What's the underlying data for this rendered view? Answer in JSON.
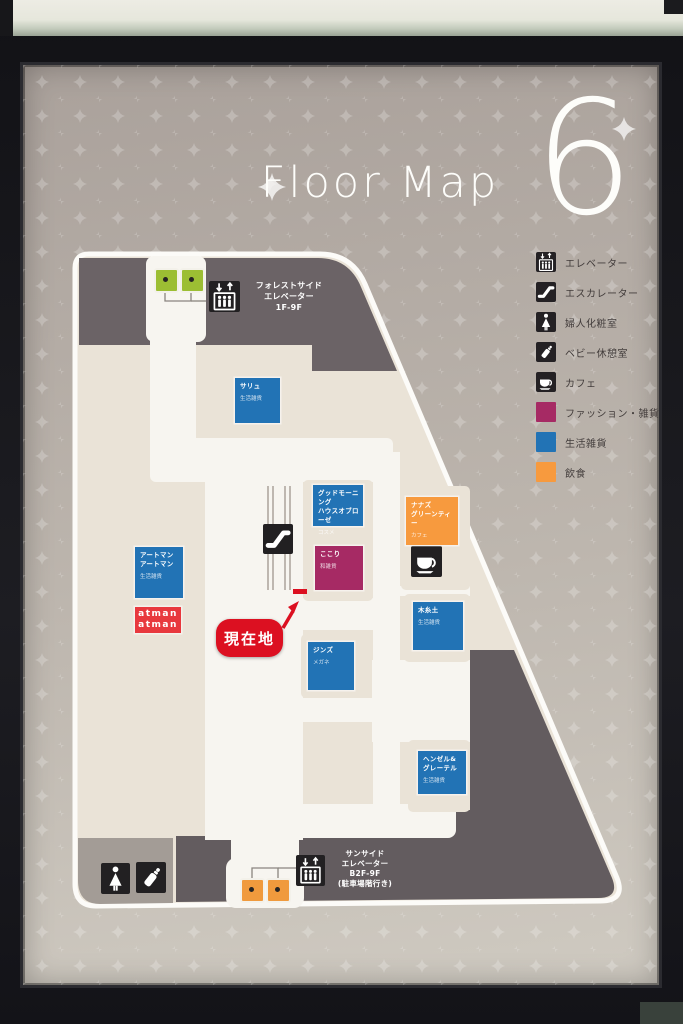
{
  "sign": {
    "title": "Floor Map",
    "floor_number": "6",
    "legend": {
      "items": [
        {
          "icon": "elevator-icon",
          "label": "エレベーター"
        },
        {
          "icon": "escalator-icon",
          "label": "エスカレーター"
        },
        {
          "icon": "powder-room-icon",
          "label": "婦人化粧室"
        },
        {
          "icon": "baby-room-icon",
          "label": "ベビー休憩室"
        },
        {
          "icon": "cafe-icon",
          "label": "カフェ"
        },
        {
          "swatch": "#a62a64",
          "label": "ファッション・雑貨"
        },
        {
          "swatch": "#2273b5",
          "label": "生活雑貨"
        },
        {
          "swatch": "#f79a3e",
          "label": "飲食"
        }
      ]
    },
    "map": {
      "current_location": "現在地",
      "elevator_forest": {
        "label": "フォレストサイド\nエレベーター\n1F-9F"
      },
      "elevator_sun": {
        "label": "サンサイド\nエレベーター\nB2F-9F\n(駐車場階行き)"
      },
      "stores": [
        {
          "name": "サリュ",
          "category": "生活雑貨",
          "color": "#2273b5"
        },
        {
          "name": "グッドモーニング\nハウスオブローゼ",
          "category": "コスメ",
          "color": "#2273b5"
        },
        {
          "name": "ここり",
          "category": "和雑貨",
          "color": "#a62a64"
        },
        {
          "name": "ナナズ\nグリーンティー",
          "category": "カフェ",
          "color": "#f79a3e"
        },
        {
          "name": "アートマン\nアートマン",
          "category": "生活雑貨",
          "color": "#2273b5"
        },
        {
          "name": "ジンズ",
          "category": "メガネ",
          "color": "#2273b5"
        },
        {
          "name": "木糸土",
          "category": "生活雑貨",
          "color": "#2273b5"
        },
        {
          "name": "ヘンゼル&\nグレーテル",
          "category": "生活雑貨",
          "color": "#2273b5"
        }
      ],
      "logo_box": {
        "text": "atman\natman",
        "color": "#e8383d"
      }
    }
  },
  "colors": {
    "accent_red": "#dc1021",
    "fashion_magenta": "#a62a64",
    "lifestyle_blue": "#2273b5",
    "food_orange": "#f79a3e",
    "elevator_car_green": "#9cbe33",
    "elevator_car_orange": "#f09a3d",
    "service_area_dark": "#6b6366",
    "floor_cream": "#eae3d7",
    "corridor_white": "#f7f5f0"
  }
}
